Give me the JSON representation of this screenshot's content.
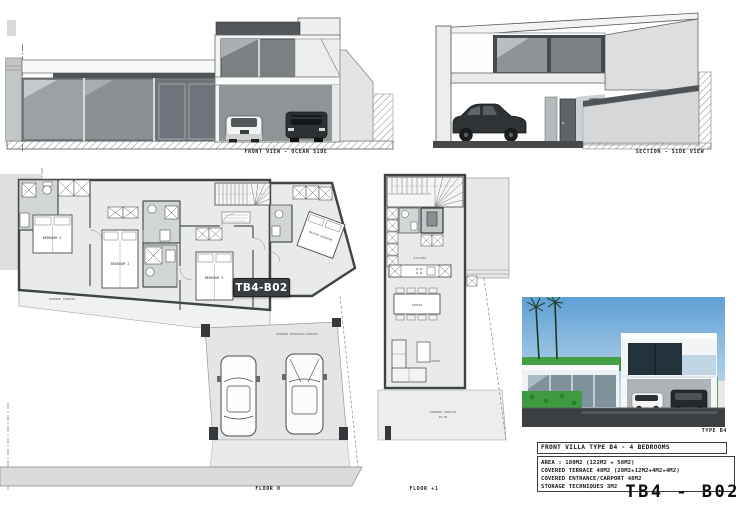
{
  "sheet": {
    "code": "TB4 - B02"
  },
  "overlay_badge": {
    "label": "TB4-B02"
  },
  "views": {
    "front_elevation": {
      "caption": "FRONT VIEW - OCEAN SIDE"
    },
    "section": {
      "caption": "SECTION - SIDE VIEW"
    },
    "floor0": {
      "caption": "FLOOR 0",
      "rooms": {
        "bedroom1": "BEDROOM 1",
        "bedroom2": "BEDROOM 2",
        "bedroom3": "BEDROOM 3",
        "master_bedroom": "MASTER BEDROOM",
        "covered_terrace": "COVERED TERRACE",
        "carport": "COVERED ENTRANCE/CARPORT"
      }
    },
    "floor1": {
      "caption": "FLOOR +1",
      "rooms": {
        "kitchen": "KITCHEN",
        "dining": "DINING",
        "lounge": "LOUNGE",
        "covered_terrace": "COVERED TERRACE",
        "terrace_area": "48 M2"
      }
    },
    "render": {
      "caption": "TYPE B4"
    }
  },
  "title_block": {
    "title": "FRONT VILLA TYPE B4 - 4 BEDROOMS",
    "lines": [
      "AREA : 180M2 (122M2 + 58M2)",
      "COVERED TERRACE 48M2 (28M2+12M2+4M2+4M2)",
      "COVERED ENTRANCE/CARPORT 48M2",
      "STORAGE TECHNIQUES 3M2"
    ]
  },
  "colors": {
    "wall_dark": "#3e4347",
    "plan_fill": "#e9eaea",
    "bath_fill": "#d2d5d6",
    "badge_bg": "#3a3d40",
    "badge_text": "#ffffff",
    "render_sky": "#5f9fd4",
    "render_green": "#3f9b3f",
    "render_asphalt": "#3c3f42"
  }
}
